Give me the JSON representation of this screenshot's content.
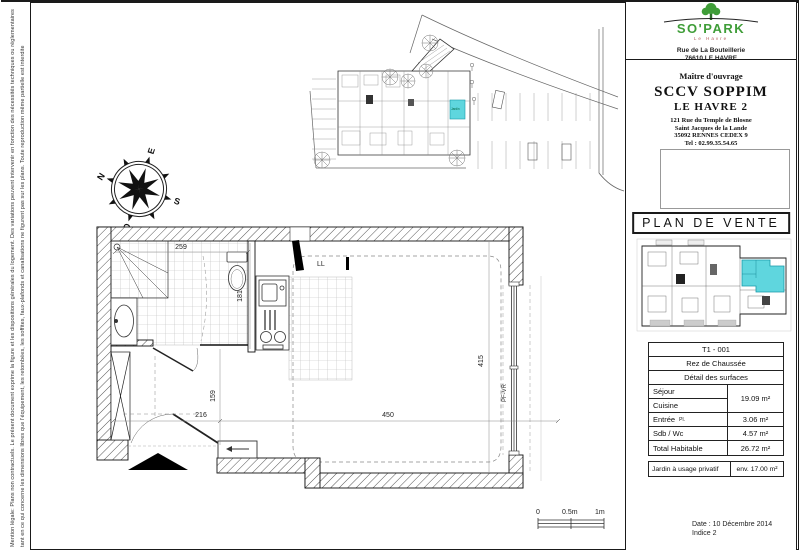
{
  "legal": {
    "line1": "Mention légale: Plans non contractuels. Le présent document exprime la figure et les dispositions générales du logement. Des variations peuvent intervenir en fonction des nécessités techniques ou réglementaires",
    "line2": "tant en ce qui concerne les dimensions libres que l'équipement, les retombées, les soffites, faux-plafonds et canalisations ne figurent pas sur les plans. Toute reproduction même partielle est interdite"
  },
  "logo": {
    "name": "SO'PARK",
    "place": "Le Havre",
    "address_line1": "Rue de La Bouteillerie",
    "address_line2": "76610 LE HAVRE",
    "green": "#3f9d38"
  },
  "owner": {
    "label": "Maître d'ouvrage",
    "company": "SCCV SOPPIM",
    "project": "LE HAVRE 2",
    "address_line1": "121 Rue du Temple de Blosne",
    "address_line2": "Saint Jacques de la Lande",
    "address_line3": "35092 RENNES CEDEX 9",
    "phone": "Tel : 02.99.35.54.65"
  },
  "sale_title": "PLAN DE VENTE",
  "key_plan": {
    "highlight_color": "#5fd6de"
  },
  "surface_table": {
    "unit": "T1 - 001",
    "level": "Rez de Chaussée",
    "header": "Détail des surfaces",
    "sejour_label": "Séjour",
    "cuisine_label": "Cuisine",
    "sejour_cuisine_value": "19.09 m²",
    "entree_label": "Entrée",
    "entree_note": "Pl.",
    "entree_value": "3.06 m²",
    "sdb_label": "Sdb / Wc",
    "sdb_value": "4.57 m²",
    "total_label": "Total Habitable",
    "total_value": "26.72 m²",
    "jardin_label": "Jardin à usage privatif",
    "jardin_value": "env. 17.00 m²"
  },
  "footer": {
    "date": "Date : 10 Décembre 2014",
    "indice": "Indice 2"
  },
  "floor_plan": {
    "dims": {
      "d259": "259",
      "d181": "181",
      "d216": "216",
      "d159": "159",
      "d450": "450",
      "d415": "415"
    },
    "labels": {
      "ll": "LL",
      "pfvr": "PF-VR"
    }
  },
  "site_plan": {
    "jardin_label": "Jardin"
  },
  "compass": {
    "top": "E",
    "right": "S",
    "bottom": "O",
    "left": "N"
  },
  "scale_bar": {
    "t0": "0",
    "t1": "0.5m",
    "t2": "1m"
  }
}
